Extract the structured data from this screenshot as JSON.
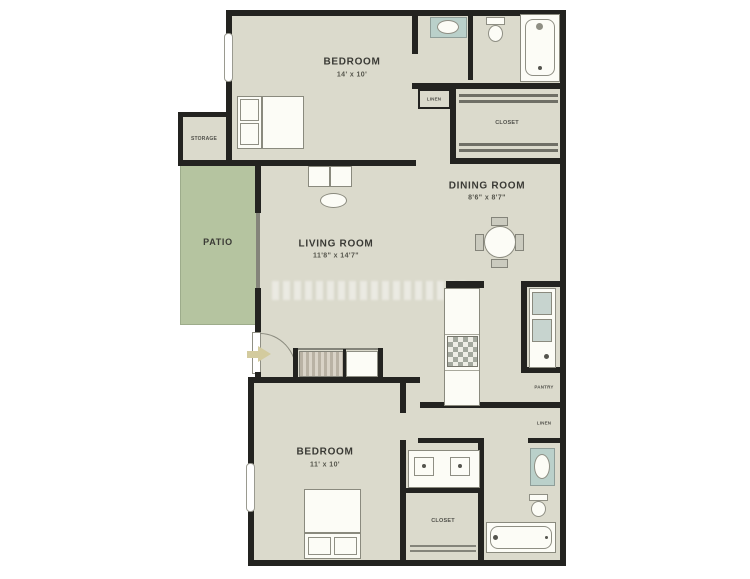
{
  "rooms": {
    "bedroom_top": {
      "label": "BEDROOM",
      "dimensions": "14' x 10'"
    },
    "dining_room": {
      "label": "DINING ROOM",
      "dimensions": "8'6\" x 8'7\""
    },
    "living_room": {
      "label": "LIVING ROOM",
      "dimensions": "11'8\" x 14'7\""
    },
    "patio": {
      "label": "PATIO"
    },
    "bedroom_bottom": {
      "label": "BEDROOM",
      "dimensions": "11' x 10'"
    },
    "storage": {
      "label": "STORAGE"
    },
    "linen_top": {
      "label": "LINEN"
    },
    "closet_top": {
      "label": "CLOSET"
    },
    "pantry": {
      "label": "PANTRY"
    },
    "linen_right": {
      "label": "LINEN"
    },
    "closet_bottom": {
      "label": "CLOSET"
    }
  },
  "colors": {
    "wall": "#232320",
    "floor": "#dbdacc",
    "patio": "#b5c4a0",
    "fixture_border": "#8a8a7e",
    "teal_fixture": "#bad0ca",
    "label_text": "#3a3a35"
  }
}
